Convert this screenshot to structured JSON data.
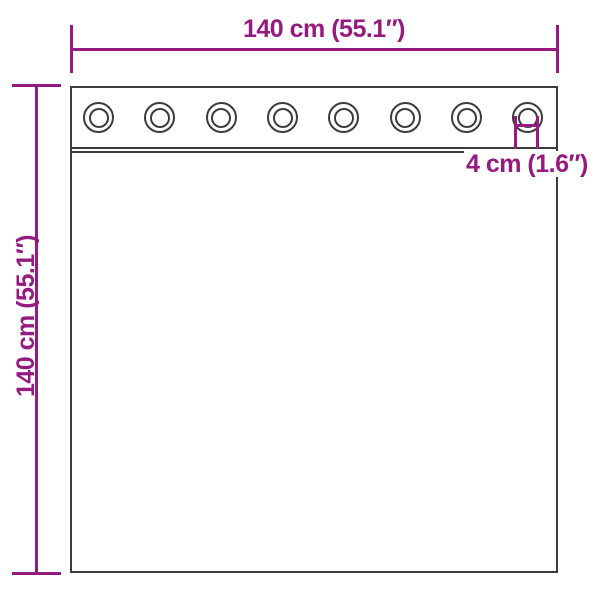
{
  "colors": {
    "accent": "#951B81",
    "outline": "#3C3C3B",
    "background": "#FFFFFF"
  },
  "diagram": {
    "subject": "curtain-panel-with-grommets",
    "width_label": "140 cm (55.1″)",
    "height_label": "140 cm (55.1″)",
    "grommet_diameter_label": "4 cm (1.6″)",
    "grommets": {
      "count": 8
    }
  }
}
